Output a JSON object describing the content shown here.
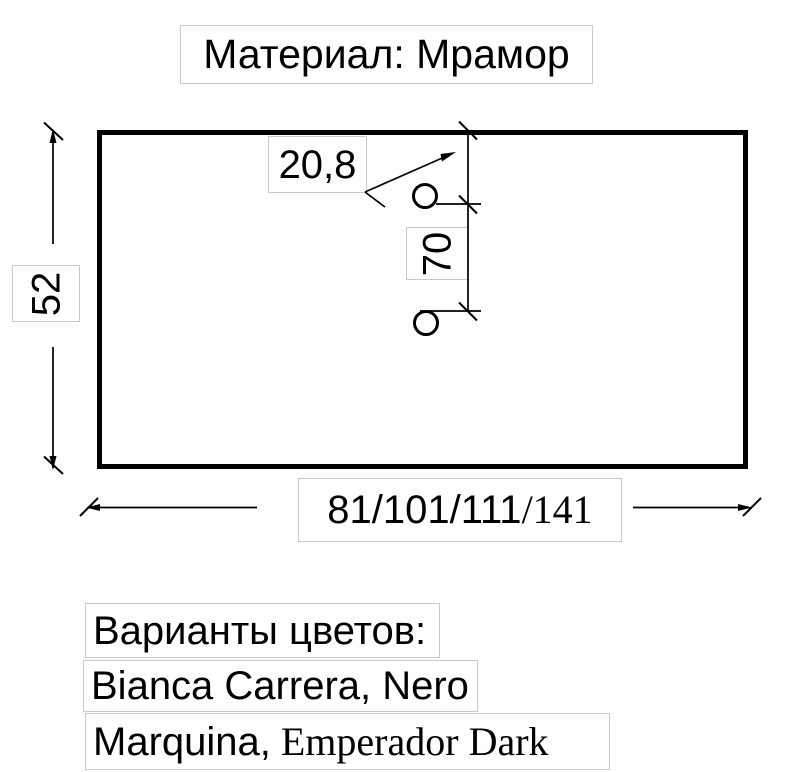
{
  "title": {
    "text": "Материал: Мрамор"
  },
  "dimensions": {
    "height_label": "52",
    "hole_offset_label": "20,8",
    "hole_spacing_label": "70",
    "width_label_sans": "81/101/111",
    "width_label_serif": "/141"
  },
  "color_options": {
    "heading": "Варианты цветов:",
    "line2": "Bianca Carrera, Nero",
    "line3_sans": "Marquina,",
    "line3_serif": " Emperador Dark"
  },
  "palette": {
    "ink": "#000000",
    "box_border": "#c9c9c9",
    "background": "#ffffff"
  }
}
